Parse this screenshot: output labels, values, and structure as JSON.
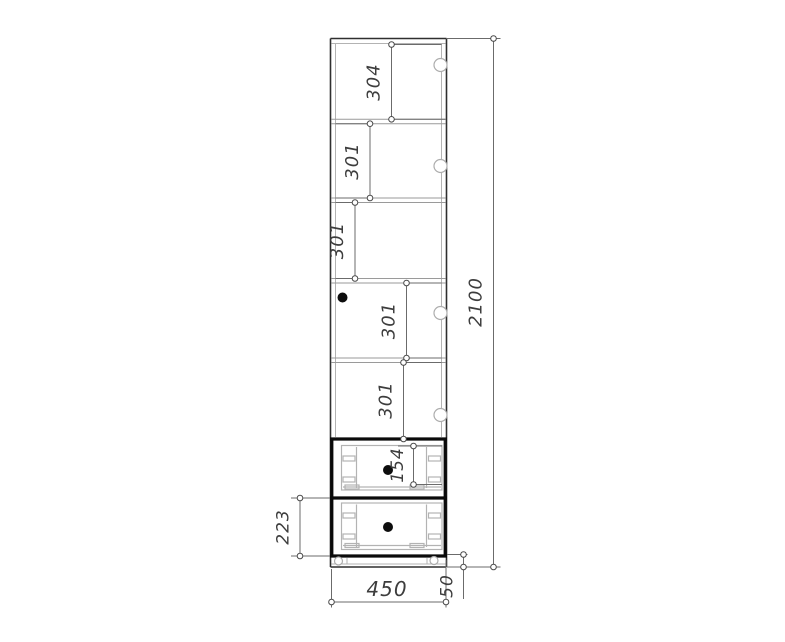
{
  "drawing": {
    "kind": "furniture-cabinet-front-elevation",
    "dimensions": {
      "section_top": {
        "label": "304"
      },
      "section_2": {
        "label": "301"
      },
      "section_3": {
        "label": "301"
      },
      "section_4": {
        "label": "301"
      },
      "section_5": {
        "label": "301"
      },
      "drawer_top_front": {
        "label": "154"
      },
      "drawer_bottom_front": {
        "label": "223"
      },
      "overall_height": {
        "label": "2100"
      },
      "overall_width": {
        "label": "450"
      },
      "plinth_height": {
        "label": "50"
      }
    },
    "colors": {
      "background": "#ffffff",
      "outline": "#2f2f2f",
      "thick_line": "#0a0a0a",
      "shelf_line": "#9a9a9a",
      "light_line": "#b3b3b3",
      "dimension_line": "#6b6b6b",
      "marker_stroke": "#4a4a4a",
      "dimension_text": "#3d3d3d",
      "knob": "#0d0d0d"
    }
  }
}
